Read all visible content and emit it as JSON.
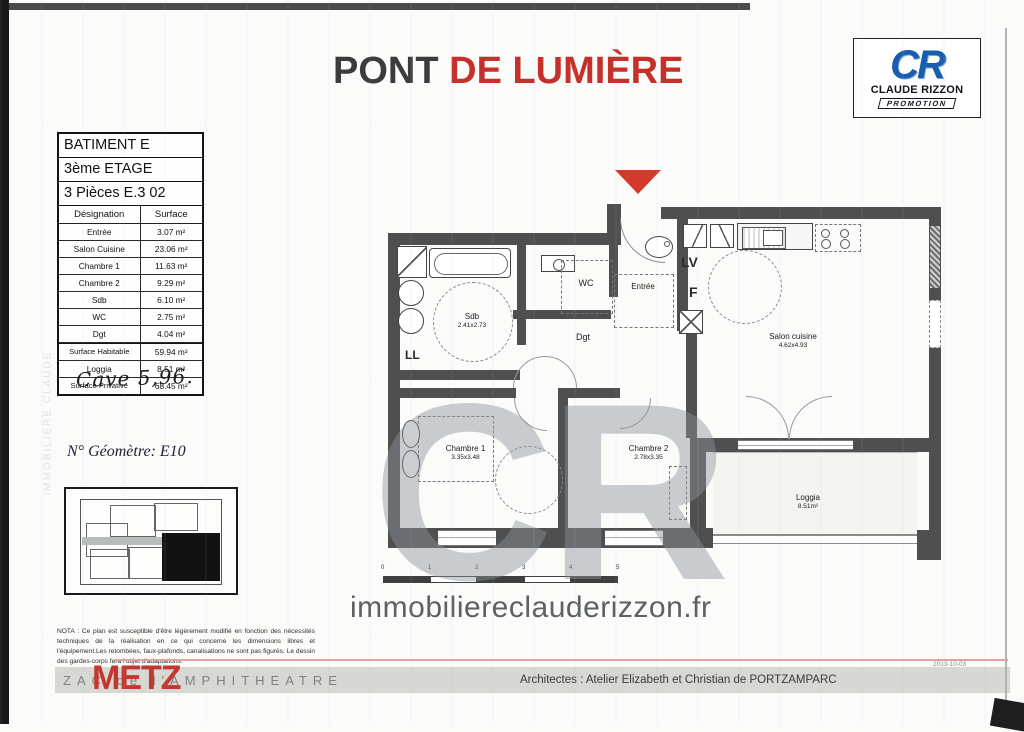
{
  "header": {
    "title": {
      "part1": "PONT",
      "part2": "DE LUMIÈRE"
    },
    "logo": {
      "monogram": "CR",
      "company": "CLAUDE RIZZON",
      "tagline": "PROMOTION"
    }
  },
  "unit_info": {
    "building": "BATIMENT E",
    "floor": "3ème ETAGE",
    "unit": "3 Pièces E.3 02",
    "col_designation": "Désignation",
    "col_surface": "Surface",
    "rows": [
      {
        "label": "Entrée",
        "value": "3.07 m²"
      },
      {
        "label": "Salon Cuisine",
        "value": "23.06 m²"
      },
      {
        "label": "Chambre 1",
        "value": "11.63 m²"
      },
      {
        "label": "Chambre 2",
        "value": "9.29 m²"
      },
      {
        "label": "Sdb",
        "value": "6.10 m²"
      },
      {
        "label": "WC",
        "value": "2.75 m²"
      },
      {
        "label": "Dgt",
        "value": "4.04 m²"
      }
    ],
    "totals": [
      {
        "label": "Surface Habitable",
        "value": "59.94 m²"
      },
      {
        "label": "Loggia",
        "value": "8.51 m²"
      },
      {
        "label": "Surface Privative",
        "value": "68.45 m²"
      }
    ]
  },
  "annotations": {
    "handwritten": "Cave 5,96.",
    "geometre": "N° Géomètre: E10"
  },
  "plan": {
    "rooms": {
      "sdb": {
        "name": "Sdb",
        "dims": "2.41x2.73"
      },
      "wc": {
        "name": "WC"
      },
      "dgt": {
        "name": "Dgt"
      },
      "entree": {
        "name": "Entrée"
      },
      "salon": {
        "name": "Salon cuisine",
        "dims": "4.62x4.93"
      },
      "chambre1": {
        "name": "Chambre 1",
        "dims": "3.35x3.48"
      },
      "chambre2": {
        "name": "Chambre 2",
        "dims": "2.78x3.35"
      },
      "loggia": {
        "name": "Loggia",
        "dims": "8.51m²"
      }
    },
    "labels": {
      "ll": "LL",
      "lv": "LV",
      "f": "F"
    },
    "scale_ticks": [
      "0",
      "1",
      "2",
      "3",
      "4",
      "5"
    ],
    "watermark": "CR"
  },
  "nota": "NOTA : Ce plan est susceptible d'être légèrement modifié en fonction des nécessités techniques de la réalisation en ce qui concerne les dimensions libres et l'équipement.Les retombées, faux-plafonds, canalisations ne sont pas figurés. Le dessin des gardes-corps fera l'objet d'adaptations.",
  "website": "immobiliereclauderizzon.fr",
  "footer": {
    "city": "METZ",
    "district": "ZAC de l'AMPHITHEATRE",
    "architects": "Architectes :  Atelier Elizabeth et Christian de PORTZAMPARC",
    "date": "2013-10-03"
  },
  "colors": {
    "accent_red": "#c5302b",
    "logo_blue": "#1a5dae",
    "wall_gray": "#4f4f4f",
    "watermark_gray": "#8e959b"
  }
}
